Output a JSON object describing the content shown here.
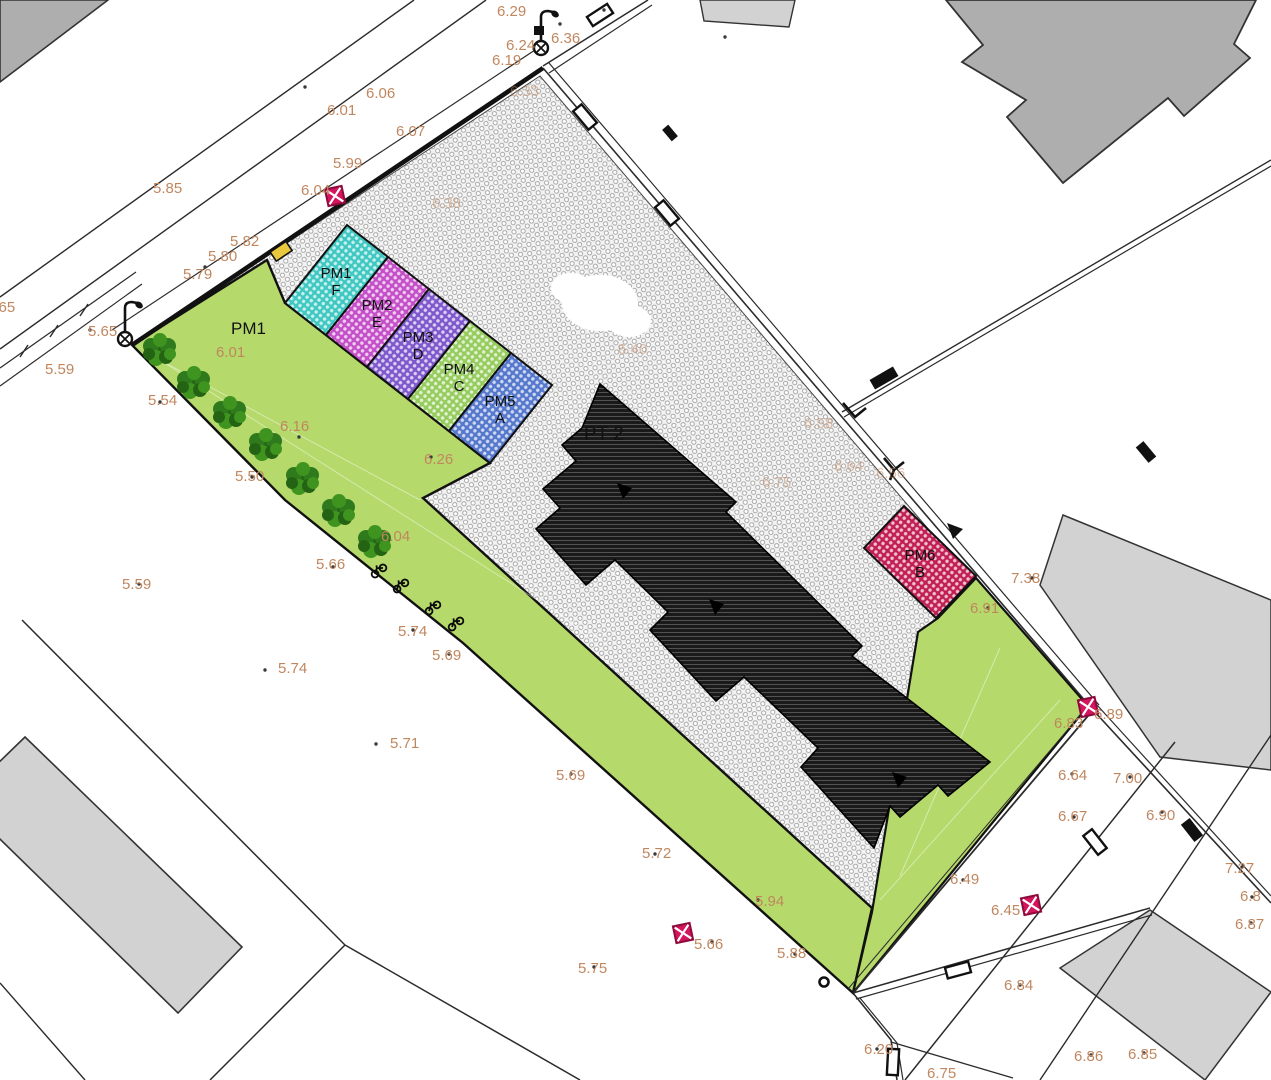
{
  "plan": {
    "building_label": "PT 2",
    "zone_label": "PM1"
  },
  "palette": {
    "green_area": "#b5d96a",
    "pavement_dot": "#9a9a9a",
    "building_fill": "#1a1a1a",
    "building_hatch_line": "#606060",
    "neighbor_gray_dark": "#aeaeae",
    "neighbor_gray_light": "#d2d2d2",
    "label_color": "#c0875f",
    "marker_crimson": "#d4155e",
    "marker_outline": "#8c0a3c",
    "tree_green_dark": "#256314",
    "tree_green_mid": "#2f7a1d",
    "tree_green_light": "#3f941f",
    "line_color": "#2b2b2b",
    "yellow_marker": "#e8c93e"
  },
  "parking_spaces": [
    {
      "id": "PM1",
      "letter": "F",
      "color": "#3fc8c2"
    },
    {
      "id": "PM2",
      "letter": "E",
      "color": "#c44fc8"
    },
    {
      "id": "PM3",
      "letter": "D",
      "color": "#7e58cc"
    },
    {
      "id": "PM4",
      "letter": "C",
      "color": "#96cc5e"
    },
    {
      "id": "PM5",
      "letter": "A",
      "color": "#5578cc"
    },
    {
      "id": "PM6",
      "letter": "B",
      "color": "#c21f55"
    }
  ],
  "elevation_labels": [
    {
      "t": "6.29",
      "x": 497,
      "y": 16
    },
    {
      "t": "6.24",
      "x": 506,
      "y": 50
    },
    {
      "t": "6.36",
      "x": 551,
      "y": 43
    },
    {
      "t": "6.19",
      "x": 492,
      "y": 65
    },
    {
      "t": "6.06",
      "x": 366,
      "y": 98
    },
    {
      "t": "6.01",
      "x": 327,
      "y": 115
    },
    {
      "t": "6.07",
      "x": 396,
      "y": 136
    },
    {
      "t": "5.99",
      "x": 333,
      "y": 168
    },
    {
      "t": "6.04",
      "x": 301,
      "y": 195
    },
    {
      "t": "5.85",
      "x": 153,
      "y": 193
    },
    {
      "t": "5.82",
      "x": 230,
      "y": 246
    },
    {
      "t": "5.80",
      "x": 208,
      "y": 261
    },
    {
      "t": "5.79",
      "x": 183,
      "y": 279
    },
    {
      "t": "5.65",
      "x": -14,
      "y": 312
    },
    {
      "t": "5.65",
      "x": 88,
      "y": 336
    },
    {
      "t": "5.59",
      "x": 45,
      "y": 374
    },
    {
      "t": "6.01",
      "x": 216,
      "y": 357
    },
    {
      "t": "5.54",
      "x": 148,
      "y": 405
    },
    {
      "t": "6.16",
      "x": 280,
      "y": 431
    },
    {
      "t": "5.50",
      "x": 235,
      "y": 481
    },
    {
      "t": "6.26",
      "x": 424,
      "y": 464
    },
    {
      "t": "6.04",
      "x": 381,
      "y": 541
    },
    {
      "t": "5.66",
      "x": 316,
      "y": 569
    },
    {
      "t": "5.59",
      "x": 122,
      "y": 589
    },
    {
      "t": "5.74",
      "x": 398,
      "y": 636
    },
    {
      "t": "5.69",
      "x": 432,
      "y": 660
    },
    {
      "t": "5.74",
      "x": 278,
      "y": 673
    },
    {
      "t": "5.71",
      "x": 390,
      "y": 748
    },
    {
      "t": "5.69",
      "x": 556,
      "y": 780
    },
    {
      "t": "5.72",
      "x": 642,
      "y": 858
    },
    {
      "t": "5.94",
      "x": 755,
      "y": 906
    },
    {
      "t": "5.75",
      "x": 578,
      "y": 973
    },
    {
      "t": "5.66",
      "x": 694,
      "y": 949
    },
    {
      "t": "5.88",
      "x": 777,
      "y": 958
    },
    {
      "t": "6.49",
      "x": 950,
      "y": 884
    },
    {
      "t": "6.45",
      "x": 991,
      "y": 915
    },
    {
      "t": "6.20",
      "x": 864,
      "y": 1054
    },
    {
      "t": "6.75",
      "x": 927,
      "y": 1078
    },
    {
      "t": "6.84",
      "x": 1004,
      "y": 990
    },
    {
      "t": "6.86",
      "x": 1074,
      "y": 1061
    },
    {
      "t": "6.85",
      "x": 1128,
      "y": 1059
    },
    {
      "t": "7.38",
      "x": 1011,
      "y": 583
    },
    {
      "t": "6.91",
      "x": 970,
      "y": 613
    },
    {
      "t": "6.83",
      "x": 1054,
      "y": 728
    },
    {
      "t": "6.89",
      "x": 1094,
      "y": 719
    },
    {
      "t": "6.64",
      "x": 1058,
      "y": 780
    },
    {
      "t": "7.00",
      "x": 1113,
      "y": 783
    },
    {
      "t": "6.67",
      "x": 1058,
      "y": 821
    },
    {
      "t": "6.90",
      "x": 1146,
      "y": 820
    },
    {
      "t": "7.27",
      "x": 1225,
      "y": 873
    },
    {
      "t": "6.8",
      "x": 1240,
      "y": 901
    },
    {
      "t": "6.87",
      "x": 1235,
      "y": 929
    }
  ],
  "faint_elevation_labels": [
    {
      "t": "6.33",
      "x": 510,
      "y": 96
    },
    {
      "t": "6.38",
      "x": 432,
      "y": 208
    },
    {
      "t": "6.40",
      "x": 618,
      "y": 354
    },
    {
      "t": "6.58",
      "x": 804,
      "y": 428
    },
    {
      "t": "6.64",
      "x": 834,
      "y": 471
    },
    {
      "t": "6.56",
      "x": 876,
      "y": 478
    },
    {
      "t": "6.75",
      "x": 762,
      "y": 487
    }
  ]
}
